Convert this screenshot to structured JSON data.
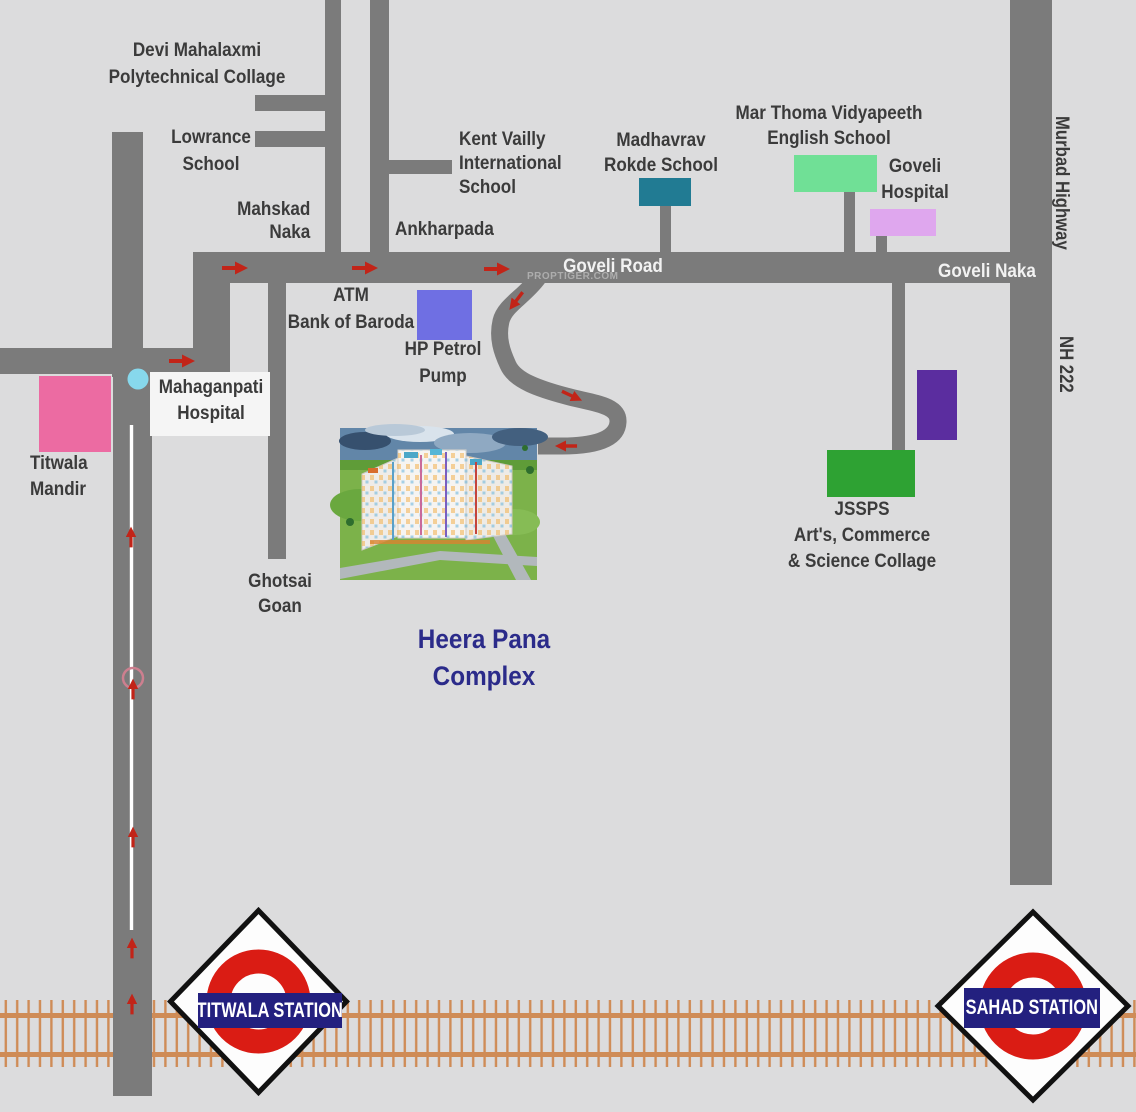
{
  "title": "Heera Pana Complex location map",
  "watermark": "PROPTIGER.COM",
  "labels": {
    "devi_mahalaxmi": "Devi Mahalaxmi\nPolytechnical Collage",
    "lowrance": "Lowrance\nSchool",
    "mahskad_naka": "Mahskad\nNaka",
    "ankharpada": "Ankharpada",
    "kent_vailly": "Kent Vailly\nInternational\nSchool",
    "madhavrav": "Madhavrav\nRokde School",
    "mar_thoma": "Mar Thoma Vidyapeeth\nEnglish School",
    "goveli_hospital": "Goveli\nHospital",
    "goveli_road": "Goveli Road",
    "goveli_naka": "Goveli Naka",
    "murbad_highway": "Murbad Highway",
    "nh_222": "NH 222",
    "atm_bank": "ATM\nBank of Baroda",
    "hp_petrol": "HP Petrol\nPump",
    "mahaganpati": "Mahaganpati\nHospital",
    "titwala_mandir": "Titwala\nMandir",
    "ghotsai_goan": "Ghotsai\nGoan",
    "heera_pana": "Heera Pana\nComplex",
    "jssps": "JSSPS\nArt's, Commerce\n& Science Collage",
    "titwala_station": "TITWALA STATION",
    "sahad_station": "SAHAD STATION"
  },
  "colors": {
    "background": "#dcdcdd",
    "road": "#7b7b7b",
    "road_label_text": "#f2f2f2",
    "label_text": "#3b3b3b",
    "titwala_mandir_marker": "#ec6ba2",
    "junction_circle": "#87d8ec",
    "atm_marker": "#6f6fe3",
    "madhavrav_school_marker": "#217b93",
    "mar_thoma_school_marker": "#70e096",
    "goveli_hospital_marker": "#dfa7ee",
    "purple_building_marker": "#5b2d9f",
    "jssps_marker": "#2ea233",
    "direction_arrow": "#c22418",
    "railway": "#cf8c57",
    "station_banner": "#23207f",
    "station_ring": "#da1c14",
    "heera_pana_text": "#2b2b8a"
  }
}
